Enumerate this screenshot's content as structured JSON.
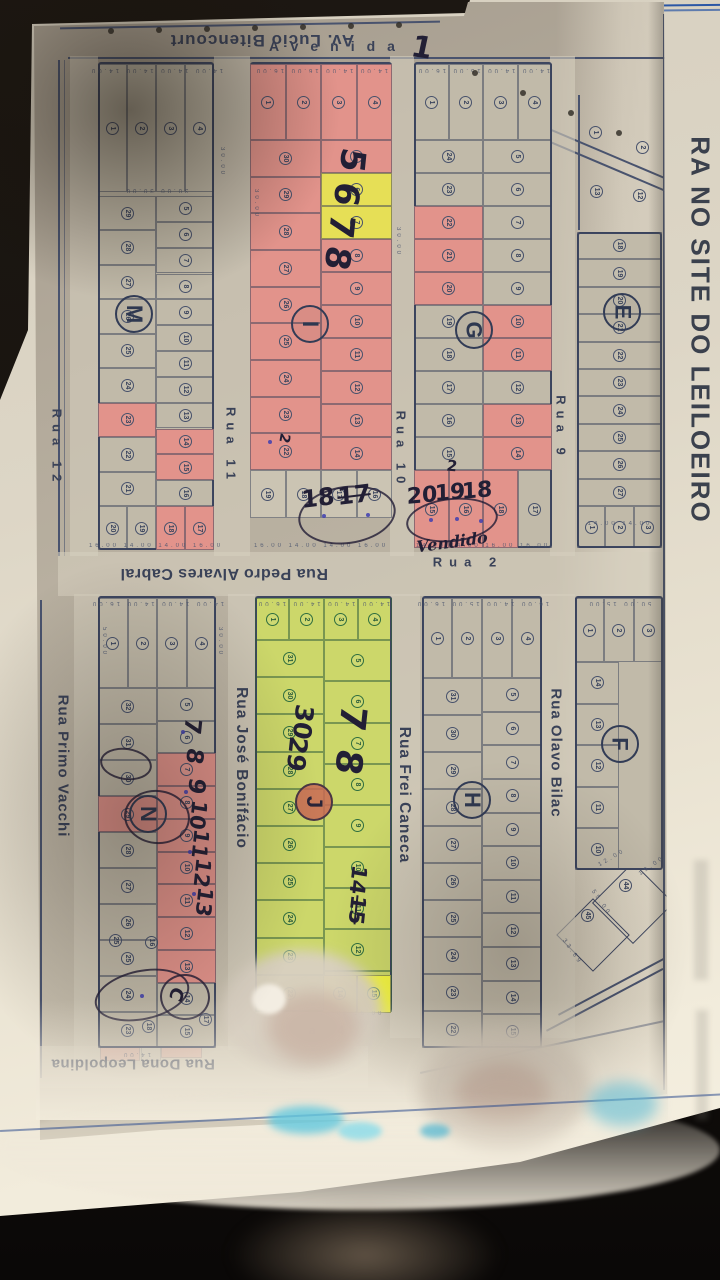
{
  "margin": {
    "vertical_text": "RA NO SITE DO LEILOEIRO"
  },
  "streets": [
    {
      "id": "av-lucio-bitencourt",
      "label": "Av. Lucio Bitencourt"
    },
    {
      "id": "avenida",
      "label": "Avenida"
    },
    {
      "id": "rua-12",
      "label": "Rua 12"
    },
    {
      "id": "rua-11",
      "label": "Rua 11"
    },
    {
      "id": "rua-10",
      "label": "Rua 10"
    },
    {
      "id": "rua-9",
      "label": "Rua 9"
    },
    {
      "id": "rua-2",
      "label": "Rua 2"
    },
    {
      "id": "rua-pedro-alvares-cabral",
      "label": "Rua Pedro Alvares Cabral"
    },
    {
      "id": "rua-primo-vacchi",
      "label": "Rua Primo Vacchi"
    },
    {
      "id": "rua-jose-bonifacio",
      "label": "Rua José Bonifácio"
    },
    {
      "id": "rua-frei-caneca",
      "label": "Rua Frei Caneca"
    },
    {
      "id": "rua-olavo-bilac",
      "label": "Rua Olavo Bilac"
    },
    {
      "id": "rua-dona-leopoldina",
      "label": "Rua Dona Leopoldina"
    },
    {
      "id": "rua-4",
      "label": "a  4"
    }
  ],
  "blocks": [
    {
      "id": "M",
      "letter": "M",
      "top_row": [
        1,
        2,
        3,
        4
      ],
      "left_col": [
        29,
        28,
        27,
        26,
        25,
        24,
        23,
        22,
        21
      ],
      "right_col": [
        5,
        6,
        7,
        8,
        9,
        10,
        11,
        12,
        13,
        14,
        15,
        16
      ],
      "bottom_row": [
        20,
        19,
        18,
        17
      ],
      "pink": {
        "left_col": [
          23
        ],
        "right_col": [
          14,
          15
        ],
        "bottom_row": [
          18,
          17
        ]
      }
    },
    {
      "id": "I",
      "letter": "I",
      "fill": "pink",
      "top_row": [
        1,
        2,
        3,
        4
      ],
      "left_col": [
        30,
        29,
        28,
        27,
        26,
        25,
        24,
        23,
        22
      ],
      "right_col": [
        5,
        6,
        7,
        8,
        9,
        10,
        11,
        12,
        13,
        14
      ],
      "bottom_row": [
        19,
        18,
        17,
        16
      ],
      "yellow": {
        "right_col": [
          6,
          7
        ]
      },
      "white_rows": [
        "bottom_row"
      ]
    },
    {
      "id": "G",
      "letter": "G",
      "top_row": [
        1,
        2,
        3,
        4
      ],
      "left_col": [
        24,
        23,
        22,
        21,
        20,
        19,
        18,
        17,
        16,
        15
      ],
      "right_col": [
        5,
        6,
        7,
        8,
        9,
        10,
        11,
        12,
        13,
        14
      ],
      "bottom_row": [
        15,
        16,
        18,
        17
      ],
      "pink": {
        "left_col": [
          22,
          21,
          20
        ],
        "right_col": [
          10,
          11,
          13,
          14
        ],
        "bottom_row": [
          15,
          16,
          18
        ]
      }
    },
    {
      "id": "E",
      "letter": "E",
      "right_col": [
        18,
        19,
        20,
        21,
        22,
        23,
        24,
        25,
        26,
        27
      ],
      "bottom_row": [
        1,
        2,
        3
      ]
    },
    {
      "id": "N",
      "letter": "N",
      "top_row": [
        1,
        2,
        3,
        4
      ],
      "left_col": [
        32,
        31,
        30,
        29,
        28,
        27,
        26,
        25,
        24,
        23
      ],
      "right_col": [
        5,
        6,
        7,
        8,
        9,
        10,
        11,
        12,
        13,
        14,
        15
      ],
      "pink": {
        "left_col": [
          29
        ],
        "right_col": [
          7,
          8,
          9,
          10,
          11,
          12,
          13
        ]
      }
    },
    {
      "id": "J",
      "letter": "J",
      "fill": "green",
      "top_row": [
        1,
        2,
        3,
        4
      ],
      "left_col": [
        31,
        30,
        29,
        28,
        27,
        26,
        25,
        24,
        23,
        22
      ],
      "right_col": [
        5,
        6,
        7,
        8,
        9,
        10,
        11,
        12,
        13
      ]
    },
    {
      "id": "H",
      "letter": "H",
      "top_row": [
        1,
        2,
        3,
        4
      ],
      "left_col": [
        31,
        30,
        29,
        28,
        27,
        26,
        25,
        24,
        23,
        22
      ],
      "right_col": [
        5,
        6,
        7,
        8,
        9,
        10,
        11,
        12,
        13,
        14,
        15
      ]
    },
    {
      "id": "F",
      "letter": "F",
      "top_row": [
        1,
        2,
        3
      ],
      "left_col": [
        14,
        13,
        12,
        11,
        10
      ]
    }
  ],
  "scatter_lots": [
    {
      "n": 1,
      "x": 596,
      "y": 133
    },
    {
      "n": 2,
      "x": 643,
      "y": 148
    },
    {
      "n": 12,
      "x": 640,
      "y": 196
    },
    {
      "n": 13,
      "x": 597,
      "y": 192
    },
    {
      "n": 44,
      "x": 626,
      "y": 886
    },
    {
      "n": 45,
      "x": 588,
      "y": 916
    },
    {
      "n": 25,
      "x": 116,
      "y": 941
    },
    {
      "n": 16,
      "x": 152,
      "y": 943
    },
    {
      "n": 18,
      "x": 149,
      "y": 1027
    },
    {
      "n": 17,
      "x": 206,
      "y": 1020
    },
    {
      "n": 14,
      "x": 340,
      "y": 994,
      "hl": "bright",
      "green": true
    },
    {
      "n": 15,
      "x": 374,
      "y": 994,
      "hl": "bright",
      "green": true
    }
  ],
  "annotations": [
    {
      "t": "1",
      "x": 422,
      "y": 48,
      "s": 30,
      "r": 8
    },
    {
      "t": "5",
      "x": 352,
      "y": 160,
      "s": 34,
      "r": 96
    },
    {
      "t": "6",
      "x": 346,
      "y": 194,
      "s": 34,
      "r": 96
    },
    {
      "t": "7",
      "x": 341,
      "y": 226,
      "s": 34,
      "r": 96
    },
    {
      "t": "8",
      "x": 337,
      "y": 258,
      "s": 34,
      "r": 96
    },
    {
      "t": "2",
      "x": 284,
      "y": 438,
      "s": 14,
      "r": 100
    },
    {
      "t": "18",
      "x": 318,
      "y": 498,
      "s": 24,
      "r": -7
    },
    {
      "t": "17",
      "x": 354,
      "y": 495,
      "s": 24,
      "r": -7,
      "k": true
    },
    {
      "t": "2",
      "x": 452,
      "y": 466,
      "s": 15,
      "r": 5
    },
    {
      "t": "20",
      "x": 422,
      "y": 496,
      "s": 22,
      "r": -5
    },
    {
      "t": "19",
      "x": 450,
      "y": 493,
      "s": 22,
      "r": -5
    },
    {
      "t": "18",
      "x": 477,
      "y": 491,
      "s": 22,
      "r": -5
    },
    {
      "t": "Vendido",
      "x": 452,
      "y": 542,
      "s": 16,
      "r": -8,
      "style": "script"
    },
    {
      "t": "30",
      "x": 303,
      "y": 722,
      "s": 25,
      "r": 96
    },
    {
      "t": "29",
      "x": 297,
      "y": 754,
      "s": 25,
      "r": 96
    },
    {
      "t": "7",
      "x": 352,
      "y": 718,
      "s": 36,
      "r": 96
    },
    {
      "t": "8",
      "x": 348,
      "y": 762,
      "s": 36,
      "r": 96
    },
    {
      "t": "14",
      "x": 358,
      "y": 880,
      "s": 21,
      "r": 96
    },
    {
      "t": "15",
      "x": 357,
      "y": 910,
      "s": 21,
      "r": 96,
      "k": true
    },
    {
      "t": "7",
      "x": 192,
      "y": 726,
      "s": 23,
      "r": 96
    },
    {
      "t": "8",
      "x": 194,
      "y": 756,
      "s": 23,
      "r": 96
    },
    {
      "t": "9",
      "x": 196,
      "y": 786,
      "s": 23,
      "r": 96
    },
    {
      "t": "10",
      "x": 198,
      "y": 815,
      "s": 21,
      "r": 96
    },
    {
      "t": "11",
      "x": 200,
      "y": 844,
      "s": 21,
      "r": 96
    },
    {
      "t": "12",
      "x": 202,
      "y": 873,
      "s": 21,
      "r": 96
    },
    {
      "t": "13",
      "x": 204,
      "y": 902,
      "s": 21,
      "r": 96
    },
    {
      "t": "C",
      "x": 176,
      "y": 994,
      "s": 18,
      "r": 110
    }
  ],
  "pen_ovals": [
    {
      "x": 298,
      "y": 486,
      "w": 94,
      "h": 54,
      "r": -8
    },
    {
      "x": 406,
      "y": 498,
      "w": 88,
      "h": 40,
      "r": -6
    },
    {
      "x": 124,
      "y": 790,
      "w": 62,
      "h": 50,
      "r": 6
    },
    {
      "x": 100,
      "y": 748,
      "w": 48,
      "h": 28,
      "r": 8
    },
    {
      "x": 94,
      "y": 970,
      "w": 92,
      "h": 46,
      "r": -12
    },
    {
      "x": 160,
      "y": 974,
      "w": 46,
      "h": 42,
      "r": 4
    }
  ],
  "ink_dots": [
    {
      "x": 322,
      "y": 514
    },
    {
      "x": 366,
      "y": 513
    },
    {
      "x": 429,
      "y": 518
    },
    {
      "x": 455,
      "y": 517
    },
    {
      "x": 479,
      "y": 519
    },
    {
      "x": 268,
      "y": 440
    },
    {
      "x": 140,
      "y": 994
    },
    {
      "x": 181,
      "y": 730
    },
    {
      "x": 184,
      "y": 790
    },
    {
      "x": 188,
      "y": 850
    },
    {
      "x": 192,
      "y": 892
    }
  ],
  "dims": [
    {
      "t": "14.00 14.00 14.00 14.00",
      "x": 156,
      "y": 70,
      "r": 180
    },
    {
      "t": "30.00   30.00",
      "x": 156,
      "y": 190,
      "r": 180
    },
    {
      "t": "14.00 14.00 16.00 16.00",
      "x": 321,
      "y": 70,
      "r": 180
    },
    {
      "t": "14.00 14.00 15.00 16.00",
      "x": 483,
      "y": 70,
      "r": 180
    },
    {
      "t": "16.00 14.00 14.00 16.00",
      "x": 156,
      "y": 546,
      "r": 0
    },
    {
      "t": "16.00 14.00 14.00 16.00",
      "x": 321,
      "y": 546,
      "r": 0
    },
    {
      "t": "14.00 14.00 16.00 16.00",
      "x": 483,
      "y": 546,
      "r": 0
    },
    {
      "t": "14.00 14.00",
      "x": 620,
      "y": 524,
      "r": 0
    },
    {
      "t": "14.00 14.00 14.00 16.00",
      "x": 157,
      "y": 603,
      "r": 180
    },
    {
      "t": "14.00 14.00 14.00 16.00",
      "x": 323,
      "y": 603,
      "r": 180
    },
    {
      "t": "16.00 14.00 15.00 16.00",
      "x": 482,
      "y": 603,
      "r": 180
    },
    {
      "t": "50.00 15.00",
      "x": 619,
      "y": 603,
      "r": 180
    },
    {
      "t": "30.00",
      "x": 222,
      "y": 162,
      "r": 90
    },
    {
      "t": "30.00",
      "x": 256,
      "y": 204,
      "r": 90
    },
    {
      "t": "30.00",
      "x": 398,
      "y": 242,
      "r": 90
    },
    {
      "t": "50.00",
      "x": 104,
      "y": 642,
      "r": 90
    },
    {
      "t": "30.00",
      "x": 220,
      "y": 642,
      "r": 90
    },
    {
      "t": "14.00 16.00",
      "x": 352,
      "y": 1014,
      "r": 0
    },
    {
      "t": "14.00",
      "x": 136,
      "y": 1054,
      "r": 180
    },
    {
      "t": "19.00",
      "x": 652,
      "y": 866,
      "r": -35
    },
    {
      "t": "12.00",
      "x": 612,
      "y": 858,
      "r": -30
    },
    {
      "t": "33.69",
      "x": 572,
      "y": 952,
      "r": 55
    },
    {
      "t": "55.00",
      "x": 601,
      "y": 903,
      "r": 55
    }
  ],
  "lot_dimensions_common": [
    "14.00",
    "15.00",
    "16.00",
    "30.00",
    "50.00",
    "12.00",
    "19.00",
    "33.69",
    "55.00"
  ]
}
